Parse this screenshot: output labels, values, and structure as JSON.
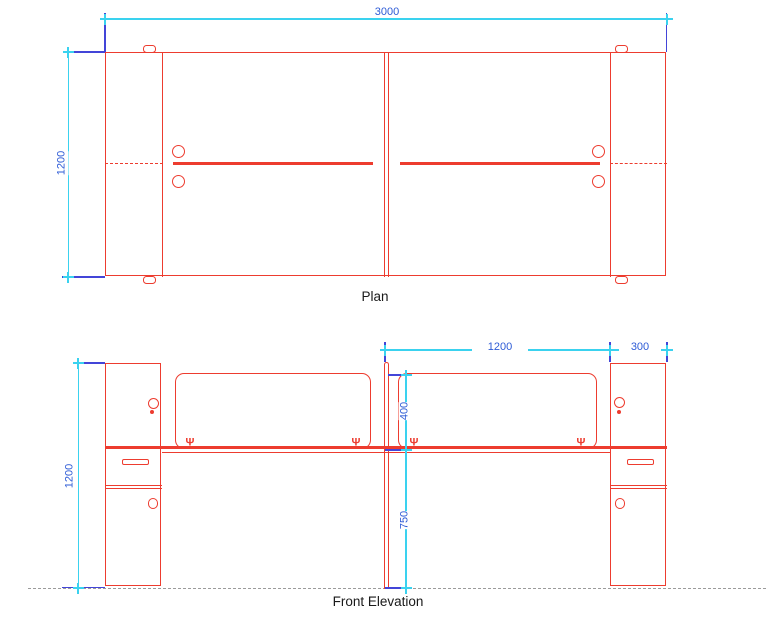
{
  "drawing": {
    "plan": {
      "title": "Plan",
      "dim_width": "3000",
      "dim_depth": "1200"
    },
    "elevation": {
      "title": "Front Elevation",
      "dim_height": "1200",
      "dim_worktop_width": "1200",
      "dim_end_panel_width": "300",
      "dim_screen_height": "400",
      "dim_desk_height": "750"
    }
  },
  "icons": {
    "clamp_glyph": "Ψ"
  },
  "colors": {
    "line_red": "#ed3c2f",
    "dim_line_cyan": "#3ad2ef",
    "dim_ext_blue": "#4345d8",
    "dim_text_blue": "#2d5bd6",
    "ground_gray": "#9b9b9b",
    "title_black": "#1a1a1a"
  }
}
